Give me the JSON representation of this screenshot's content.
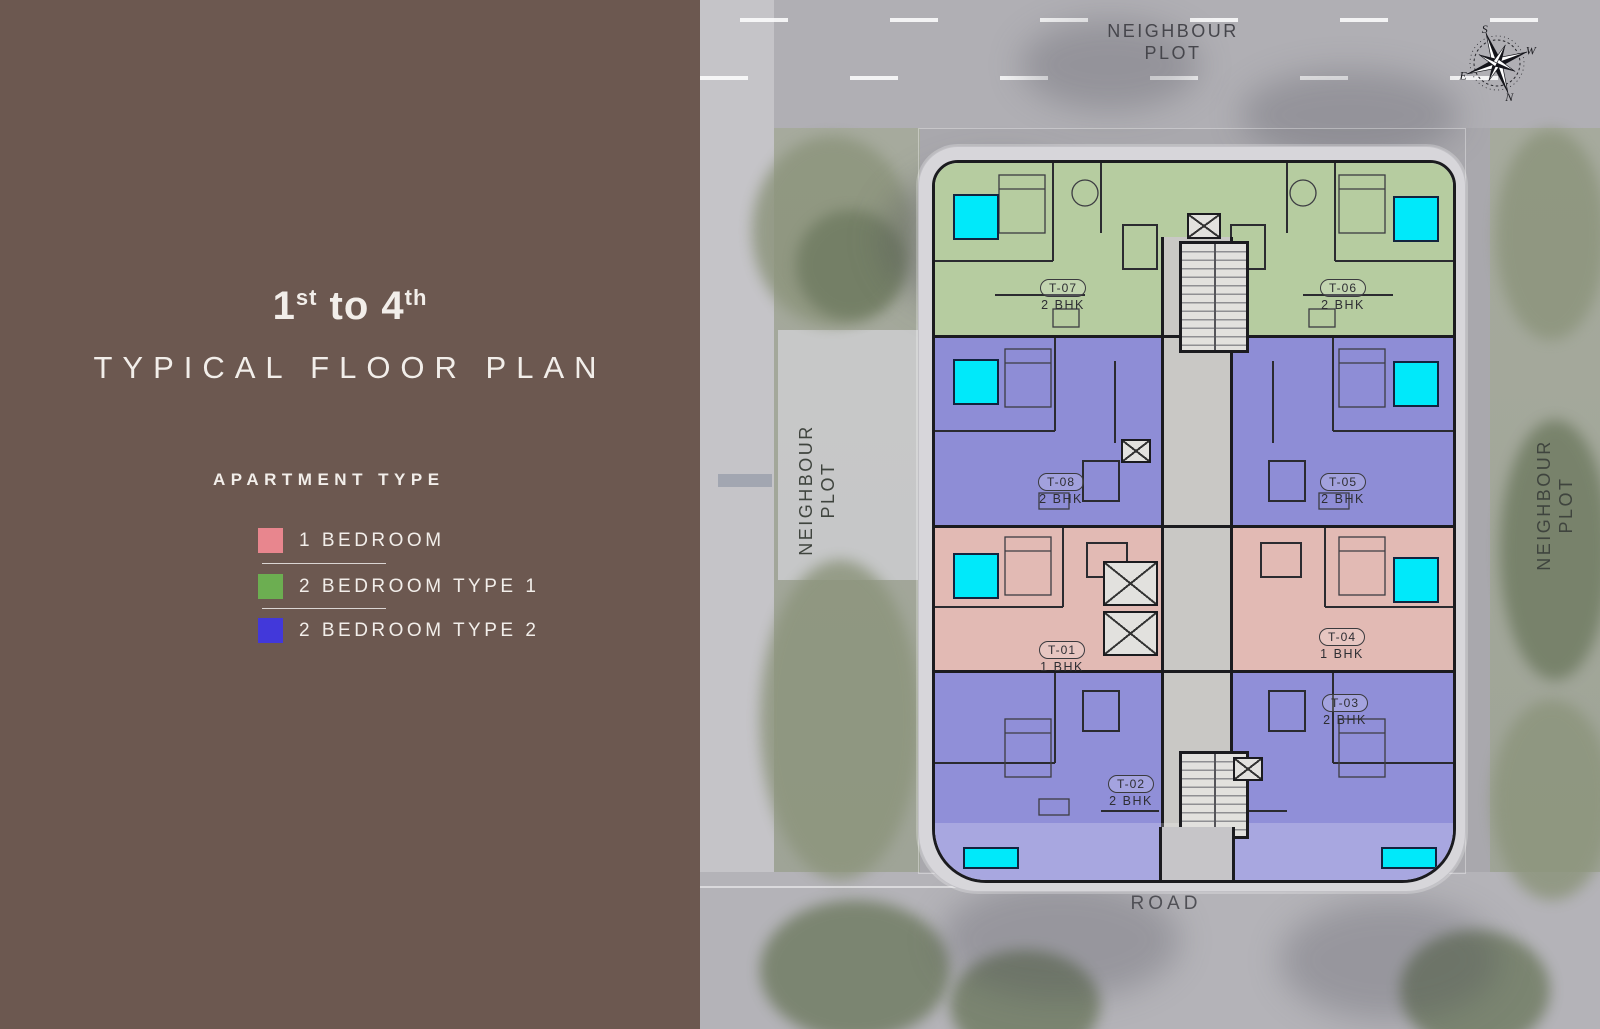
{
  "panel": {
    "floor_range": {
      "n1": "1",
      "s1": "st",
      "mid": " to ",
      "n2": "4",
      "s2": "th"
    },
    "title": "TYPICAL FLOOR PLAN",
    "legend_heading": "APARTMENT TYPE",
    "legend": [
      {
        "label": "1 BEDROOM",
        "color": "#E8868E"
      },
      {
        "label": "2 BEDROOM TYPE 1",
        "color": "#6CAE51"
      },
      {
        "label": "2 BEDROOM TYPE 2",
        "color": "#4238DA"
      }
    ]
  },
  "site": {
    "neighbour_line1": "NEIGHBOUR",
    "neighbour_line2": "PLOT",
    "road": "ROAD",
    "compass": {
      "n": "N",
      "s": "S",
      "e": "E",
      "w": "W"
    }
  },
  "plan": {
    "units": [
      {
        "id": "T-07",
        "type": "2 BHK"
      },
      {
        "id": "T-06",
        "type": "2 BHK"
      },
      {
        "id": "T-08",
        "type": "2 BHK"
      },
      {
        "id": "T-05",
        "type": "2 BHK"
      },
      {
        "id": "T-01",
        "type": "1 BHK"
      },
      {
        "id": "T-04",
        "type": "1 BHK"
      },
      {
        "id": "T-03",
        "type": "2 BHK"
      },
      {
        "id": "T-02",
        "type": "2 BHK"
      }
    ],
    "colors": {
      "one_bhk": "#E2BAB4",
      "two_bhk_type1": "#B6CCA0",
      "two_bhk_type2": "#8E8DD6",
      "two_bhk_type2_lower": "#908FD8",
      "balcony": "#00E9FA",
      "corridor": "#C9C8C5"
    }
  }
}
